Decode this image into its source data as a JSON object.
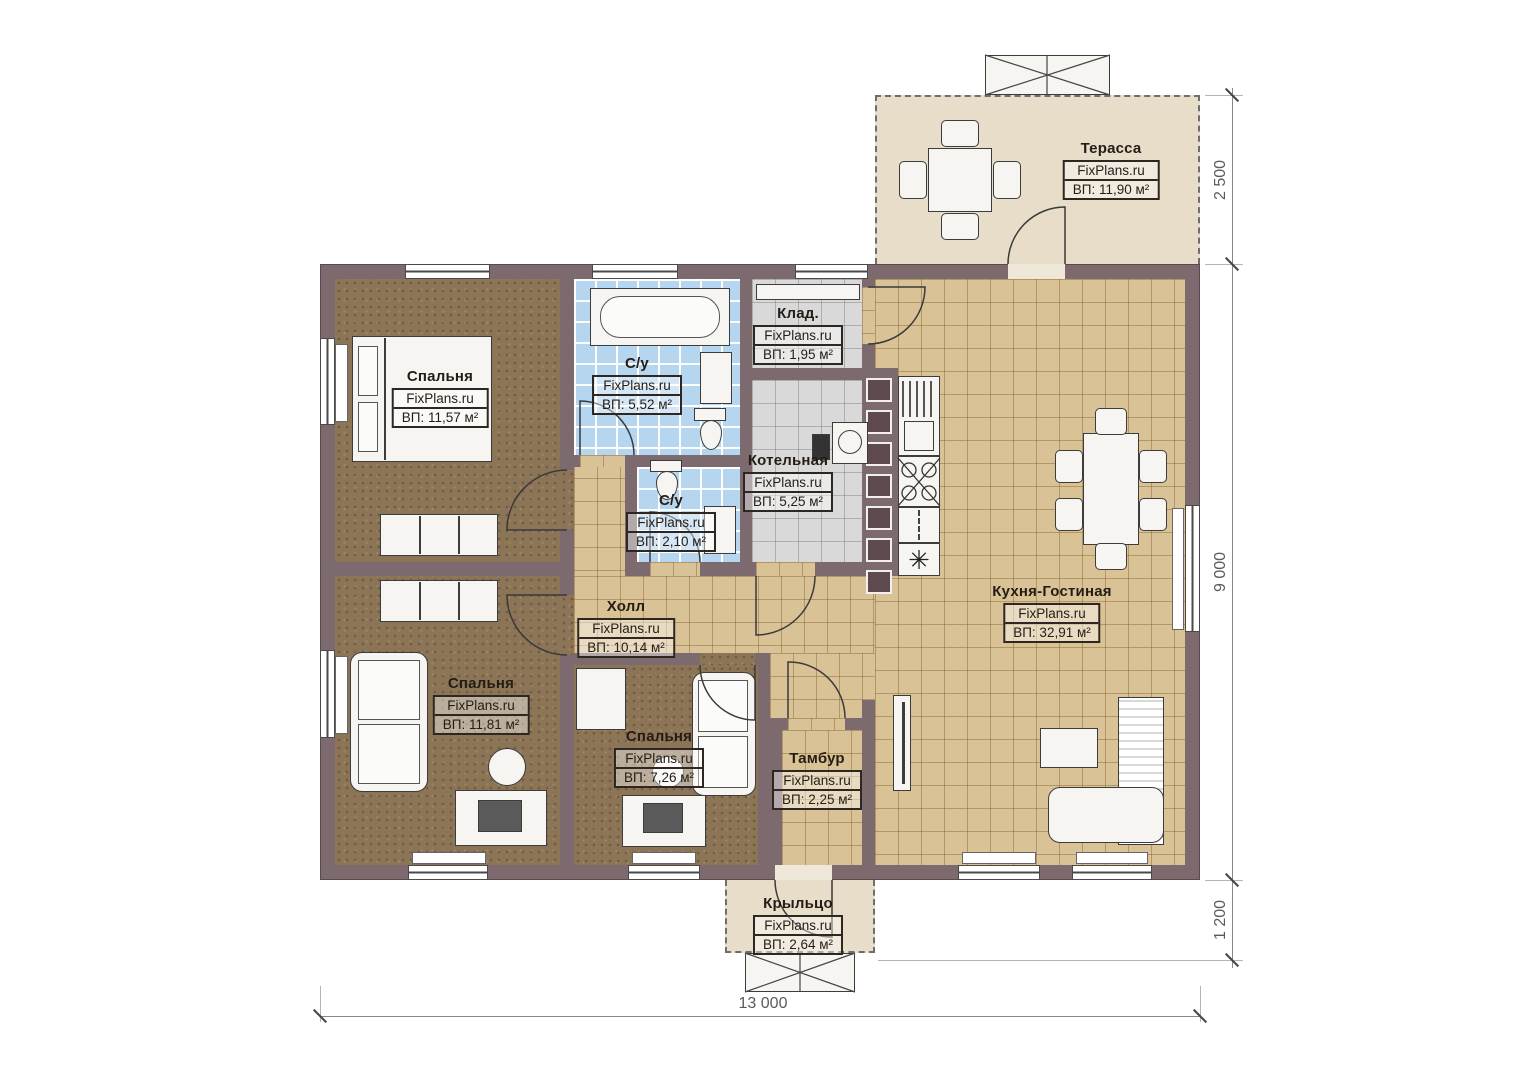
{
  "brand": "FixPlans.ru",
  "rooms": {
    "terrace": {
      "name": "Терасса",
      "area": "ВП: 11,90 м²"
    },
    "bedroom1": {
      "name": "Спальня",
      "area": "ВП: 11,57 м²"
    },
    "bathroom": {
      "name": "С/у",
      "area": "ВП: 5,52 м²"
    },
    "storage": {
      "name": "Клад.",
      "area": "ВП: 1,95 м²"
    },
    "boiler": {
      "name": "Котельная",
      "area": "ВП: 5,25 м²"
    },
    "wc": {
      "name": "С/у",
      "area": "ВП: 2,10 м²"
    },
    "hall": {
      "name": "Холл",
      "area": "ВП: 10,14 м²"
    },
    "kitchen_living": {
      "name": "Кухня-Гостиная",
      "area": "ВП: 32,91 м²"
    },
    "bedroom2": {
      "name": "Спальня",
      "area": "ВП: 11,81 м²"
    },
    "bedroom3": {
      "name": "Спальня",
      "area": "ВП: 7,26 м²"
    },
    "vestibule": {
      "name": "Тамбур",
      "area": "ВП: 2,25 м²"
    },
    "porch": {
      "name": "Крыльцо",
      "area": "ВП: 2,64 м²"
    }
  },
  "dimensions": {
    "terrace_depth": "2 500",
    "house_side": "9 000",
    "porch_depth": "1 200",
    "house_width": "13 000"
  },
  "symbols": {
    "fridge": "✳"
  },
  "colors": {
    "wall": "#7d6a6e",
    "carpet": "#8c7456",
    "tile_tan": "#d9c295",
    "tile_blue": "#b6d5ef",
    "tile_gray": "#d9d9d9",
    "terrace": "#e7ddc9"
  }
}
